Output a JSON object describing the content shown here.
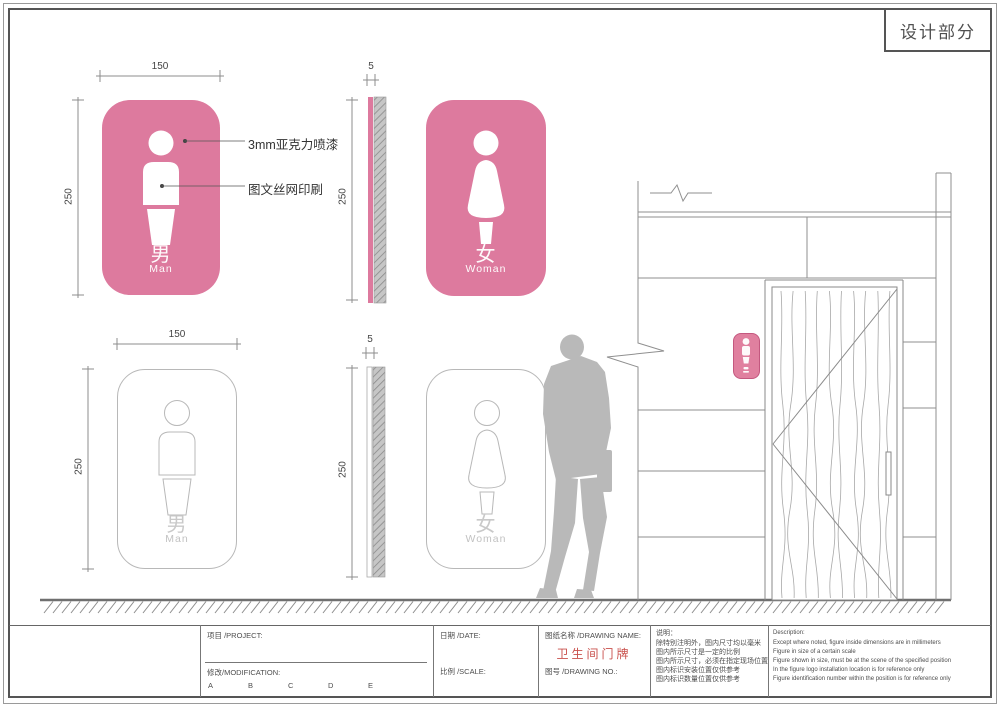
{
  "sheet": {
    "section_title": "设计部分"
  },
  "dimensions": {
    "sign_width": "150",
    "sign_height": "250",
    "sign_thickness": "5"
  },
  "annotations": {
    "material": "3mm亚克力喷漆",
    "printing": "图文丝网印刷"
  },
  "signs": {
    "man": {
      "label_zh": "男",
      "label_en": "Man"
    },
    "woman": {
      "label_zh": "女",
      "label_en": "Woman"
    }
  },
  "title_block": {
    "project_label": "项目 /PROJECT:",
    "modification_label": "修改/MODIFICATION:",
    "revision_columns": [
      "A",
      "B",
      "C",
      "D",
      "E"
    ],
    "date_label": "日期 /DATE:",
    "scale_label": "比例 /SCALE:",
    "drawing_name_label": "图纸名称 /DRAWING NAME:",
    "drawing_name": "卫生间门牌",
    "drawing_no_label": "图号 /DRAWING NO.:",
    "notes_zh_title": "说明：",
    "notes_zh": [
      "除特别注明外，图内尺寸均以毫米",
      "图内所示尺寸是一定的比例",
      "图内所示尺寸，必须在指定现场位置",
      "图内标识安装位置仅供参考",
      "图内标识数量位置仅供参考"
    ],
    "notes_en_title": "Description:",
    "notes_en": [
      "Except where noted, figure inside dimensions are in millimeters",
      "Figure in size of a certain scale",
      "Figure shown in size, must be at the scene of the specified position",
      "In the figure logo installation location is for reference only",
      "Figure identification number within the position is for reference only"
    ]
  },
  "colors": {
    "sign_pink": "#dd7a9e",
    "drawing_name_red": "#c9504c"
  }
}
